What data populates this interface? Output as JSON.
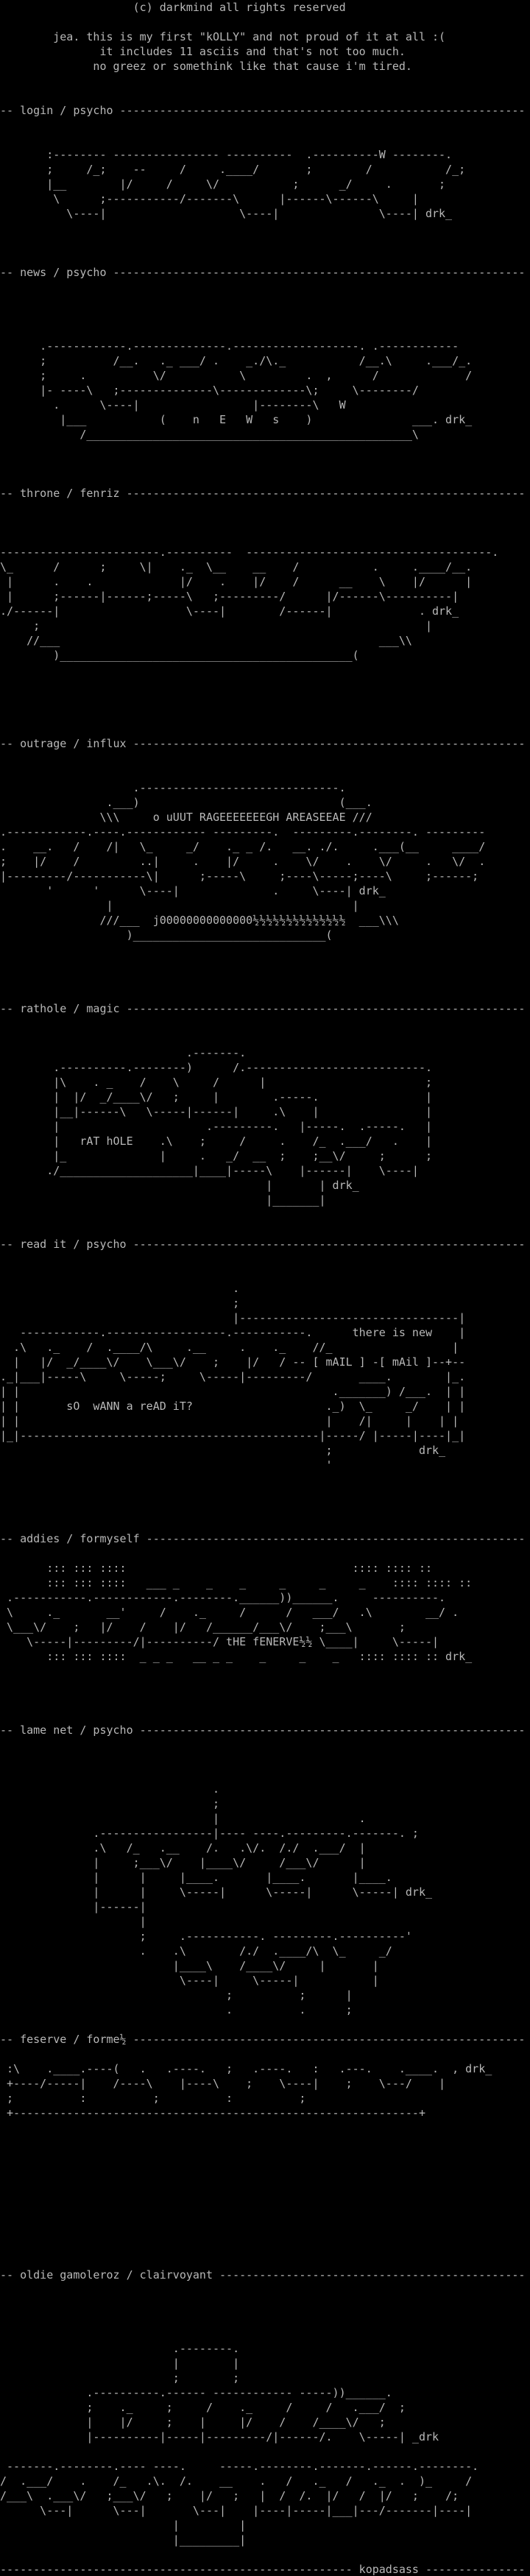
{
  "colors": {
    "background": "#000000",
    "text": "#b8b8b8"
  },
  "intro": {
    "lines": [
      "                    (c) darkmind all rights reserved",
      "",
      "        jea. this is my first \"kOLLY\" and not proud of it at all :(",
      "               it includes 11 asciis and that's not too much.",
      "              no greez or somethink like that cause i'm tired."
    ]
  },
  "sections": [
    {
      "name": "login",
      "artist": "psycho",
      "header": "-- login / psycho -------------------------------------------------------------",
      "art": [
        "       :-------- ---------------- ----------  .----------W --------.",
        "       ;     /_;    --     /     .____/       ;        /           /_;",
        "       |__        |/     /     \\/           ;      _/     .       ;",
        "        \\      ;-----------/-------\\      |------\\------\\     |",
        "          \\----|                    \\----|               \\----| drk_"
      ]
    },
    {
      "name": "news",
      "artist": "psycho",
      "header": "-- news / psycho --------------------------------------------------------------",
      "art": [
        "      .------------.--------------.-------------------. .------------",
        "      ;          /__.   ._ ___/ .    _./\\._           /__.\\     .___/_.",
        "      ;     .          \\/           \\         .  ,      /             /",
        "      |- ----\\   ;--------------\\-------------\\;     \\--------/",
        "        .      \\----|                 |--------\\   W",
        "         |___           (    n   E   W   s    )               ___. drk_",
        "            /_________________________________________________\\"
      ]
    },
    {
      "name": "throne",
      "artist": "fenriz",
      "header": "-- throne / fenriz ------------------------------------------------------------",
      "art": [
        "------------------------.----------  -------------------------------------.",
        "\\_      /      ;     \\|    ._  \\__    __    /           .     .____/__.",
        " |      .    .             |/    .    |/    /      __    \\    |/      |",
        " |      ;------|------;-----\\   ;---------/      |/------\\----------|",
        "./------|                   \\----|        /------|             . drk_",
        "     ;                                                          |",
        "    //___                                                ___\\\\",
        "        )____________________________________________("
      ]
    },
    {
      "name": "outrage",
      "artist": "influx",
      "header": "-- outrage / influx -----------------------------------------------------------",
      "art": [
        "                    .------------------------------.",
        "                .___)                              (___.",
        "               \\\\\\     o uUUT RAGEEEEEEEGH AREASEEAE ///",
        ".------------.----.------------ ---------.  ---------.--------. ---------",
        ".    __.   /    /|   \\_     _/    ._ _ /.   __. ./.     .___(__     ____/",
        ";    |/    /         ..|     .    |/     .    \\/    .    \\/     .   \\/  .",
        "|---------/-----------\\|      ;-----\\     ;----\\-----;----\\     ;------;",
        "       '      '      \\----|              .     \\----| drk_",
        "                |                                    |",
        "               ///___  j00000000000000½½½½½½½½½½½½½½  ___\\\\\\",
        "                   )_____________________________("
      ]
    },
    {
      "name": "rathole",
      "artist": "magic",
      "header": "-- rathole / magic ------------------------------------------------------------",
      "art": [
        "                            .-------.",
        "        .----------.--------)      /.---------------------------.",
        "        |\\    . _    /    \\     /      |                        ;",
        "        |  |/  _/____\\/   ;     |        .-----.                |",
        "        |__|------\\   \\-----|------|     .\\    |                |",
        "        |                      .---------.   |-----.  .-----.   |",
        "        |   rAT hOLE    .\\    ;     /     .    /_  .___/   .    |",
        "        |_              |     .   _/  __  ;    ;__\\/     ;      ;",
        "       ./____________________|____|-----\\    |------|    \\----|",
        "                                        |       | drk_",
        "                                        |_______|"
      ]
    },
    {
      "name": "read it",
      "artist": "psycho",
      "header": "-- read it / psycho -----------------------------------------------------------",
      "art": [
        "                                   .",
        "                                   ;",
        "                                   |---------------------------------|",
        "   ------------.------------------.-----------.      there is new    |",
        "  .\\   ._    /  .____/\\     .__     .    ._    //_                  |",
        "  |   |/  _/____\\/    \\___\\/    ;    |/   / -- [ mAIL ] -[ mAil ]--+--",
        "._|___|-----\\     \\-----;     \\-----|---------/       ____.        |_.",
        "| |                                               ._______) /___.  | |",
        "| |       sO  wANN a reAD iT?                    ._)  \\_     _/    | |",
        "| |                                              |    /|     |    | |",
        "|_|---------------------------------------------|-----/ |-----|----|_|",
        "                                                 ;             drk_",
        "                                                 '"
      ]
    },
    {
      "name": "addies",
      "artist": "formyself",
      "header": "-- addies / formyself ---------------------------------------------------------",
      "art": [
        "       ::: ::: ::::                                  :::: :::: ::",
        "       ::: ::: ::::   ___ _    _    _     _     _     _    :::: :::: ::",
        " .-----------.------------.--------.______))______.     ----------.",
        " \\     ._       __'     /    ._     /      /   ___/   .\\        __/ .",
        " \\___\\/    ;   |/    /    |/   /______/___\\/    ;___\\       ;",
        "    \\-----|---------/|----------/ tHE fENERVE½½ \\____|     \\-----|",
        "       ::: ::: ::::  _ _ _   __ _ _    _     _    _   :::: :::: :: drk_"
      ]
    },
    {
      "name": "lame net",
      "artist": "psycho",
      "header": "-- lame net / psycho ----------------------------------------------------------",
      "art": [
        "                                .",
        "                                ;",
        "                                |                     .",
        "              .-----------------|---- ----.---------.-------. ;",
        "              .\\   /_   .__    /.   .\\/.  /./  .___/  |",
        "              |     ;___\\/    |____\\/     /___\\/      |",
        "              |      |     |____.       |____.       |____.",
        "              |      |     \\-----|      \\-----|      \\-----| drk_",
        "              |------|",
        "                     |",
        "                     ;     .-----------. ---------.----------'",
        "                     .    .\\        /./  .____/\\  \\_     _/",
        "                          |____\\    /____\\/     |       |",
        "                           \\----|     \\-----|           |",
        "                                  ;          ;      |",
        "                                  .          .      ;"
      ]
    },
    {
      "name": "feserve",
      "artist": "forme½",
      "header": "-- feserve / forme½ -----------------------------------------------------------",
      "art": [
        " :\\    .____.----(   .   .----.   ;   .----.   :   .---.    .____.  , drk_",
        " +----/-----|    /----\\    |----\\    ;    \\----|    ;    \\---/    |",
        " ;          :          ;          :          ;",
        " +-------------------------------------------------------------+"
      ]
    },
    {
      "name": "oldie gamoleroz",
      "artist": "clairvoyant",
      "header": "-- oldie gamoleroz / clairvoyant ----------------------------------------------",
      "art": [
        "                          .--------.",
        "                          |        |",
        "                          ;        ;",
        "             .----------.------ ------------ -----))______.",
        "             ;    ._     ;     /    ._     /     /   .___/  ;",
        "             |    |/     ;    |     |/    /    /____\\/   ;",
        "             |----------|-----|---------/|------/.    \\-----| _drk",
        "",
        " -------.--------.---- ----.     -----.--------.-------.------.--------.",
        "/  .___/    .    /_   .\\.  /.    __    .   /   ._   /   ._  .  )_     /",
        "/___\\  .___\\/   ;___\\/   ;    |/   ;   |  /  /.  |/   /  |/   ;    /;",
        "      \\---|      \\---|       \\---|    |----|-----|___|---/-------|----|",
        "                          |         |",
        "                          |_________|"
      ]
    }
  ],
  "footer": {
    "line": "----------------------------------------------------- kopadsass ---------------"
  }
}
